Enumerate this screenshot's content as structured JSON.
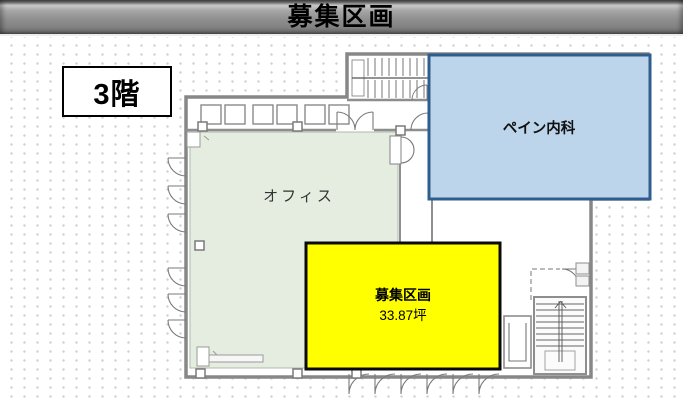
{
  "header": {
    "title": "募集区画"
  },
  "floor": {
    "label": "3階"
  },
  "plan": {
    "clinic": {
      "label": "ペイン内科",
      "fill": "#bcd5eb",
      "border": "#2f5d8e"
    },
    "office": {
      "label": "オフィス",
      "fill": "#e5ede0",
      "border": "#aeb9ac"
    },
    "vacant": {
      "label": "募集区画",
      "area": "33.87坪",
      "fill": "#ffff00",
      "border": "#0a0a0a"
    },
    "symbols": [
      "stairs-top",
      "stairs-bottom-right",
      "elevator",
      "door-swings",
      "window-band",
      "columns"
    ]
  },
  "colors": {
    "title_bar": "#8e8e8e",
    "title_text": "#000000",
    "wall_gray": "#878787",
    "dot_grid": "#d3d3d3"
  }
}
